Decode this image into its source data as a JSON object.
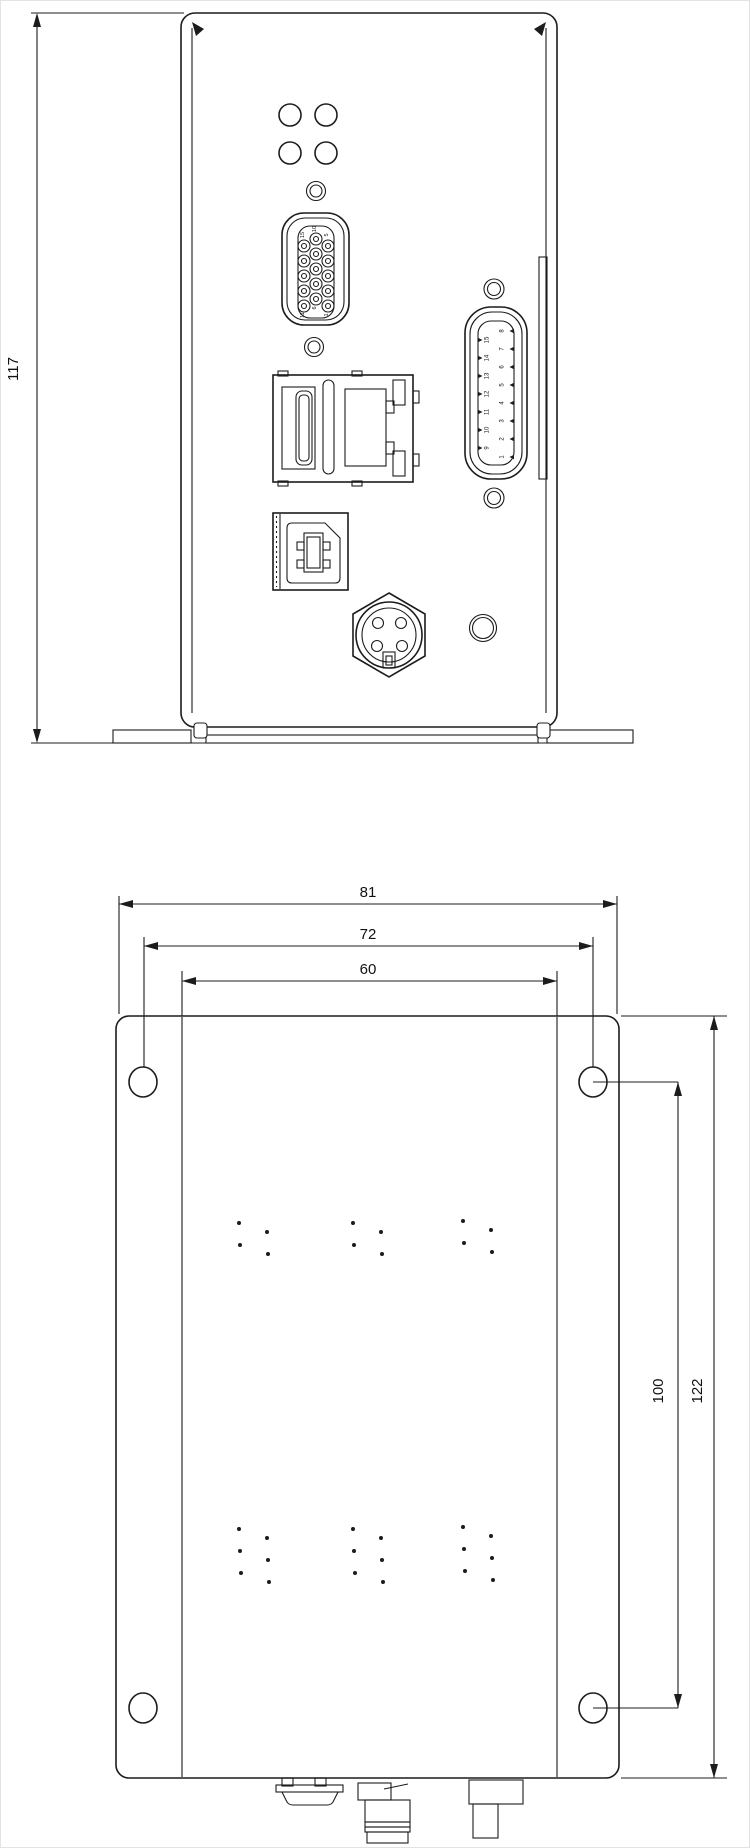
{
  "front_view": {
    "height_dim": "117",
    "connector_icons": [
      "status-led-icon",
      "screw-hole-icon",
      "hd15-connector-icon",
      "ethernet-usb-combo-icon",
      "usb-b-connector-icon",
      "power-din-connector-icon",
      "d-sub-15-connector-icon"
    ],
    "hd15_pin_labels": {
      "top_left": "15",
      "top_mid": "10",
      "top_right": "5",
      "bottom_left": "11",
      "bottom_mid": "6",
      "bottom_right": "1"
    },
    "dsub_pins_left": [
      "15",
      "14",
      "13",
      "12",
      "11",
      "10",
      "9"
    ],
    "dsub_pins_right": [
      "8",
      "7",
      "6",
      "5",
      "4",
      "3",
      "2",
      "1"
    ]
  },
  "bottom_view": {
    "width_overall": "81",
    "width_hole_spacing": "72",
    "width_body": "60",
    "height_hole_spacing": "100",
    "height_overall": "122"
  }
}
